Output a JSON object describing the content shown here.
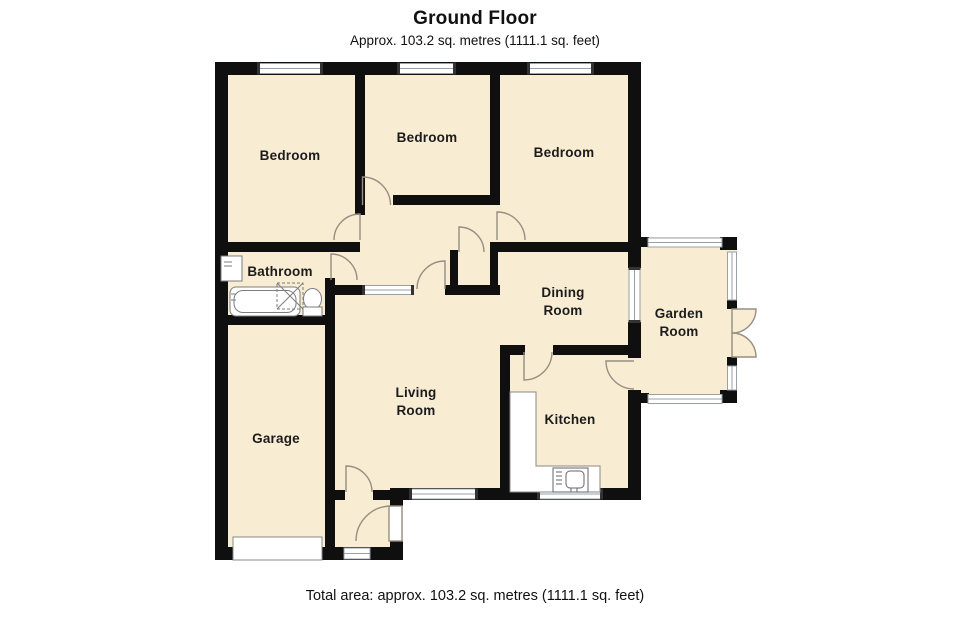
{
  "header": {
    "title": "Ground Floor",
    "subtitle": "Approx. 103.2 sq. metres (1111.1 sq. feet)"
  },
  "footer": {
    "total_area": "Total area: approx. 103.2 sq. metres (1111.1 sq. feet)"
  },
  "rooms": {
    "bedroom_left": {
      "label": "Bedroom"
    },
    "bedroom_middle": {
      "label": "Bedroom"
    },
    "bedroom_right": {
      "label": "Bedroom"
    },
    "bathroom": {
      "label": "Bathroom"
    },
    "dining": {
      "line1": "Dining",
      "line2": "Room"
    },
    "garden": {
      "line1": "Garden",
      "line2": "Room"
    },
    "living": {
      "line1": "Living",
      "line2": "Room"
    },
    "kitchen": {
      "label": "Kitchen"
    },
    "garage": {
      "label": "Garage"
    }
  },
  "fixtures": [
    "bathtub",
    "shower",
    "toilet",
    "wash-basin",
    "kitchen-counter",
    "kitchen-sink",
    "garage-door",
    "french-doors"
  ],
  "colors": {
    "room_fill": "#f8ecd3",
    "wall": "#0f0f0f",
    "window_line": "#9aa0a8",
    "door_arc": "#968f82",
    "background": "#ffffff"
  }
}
